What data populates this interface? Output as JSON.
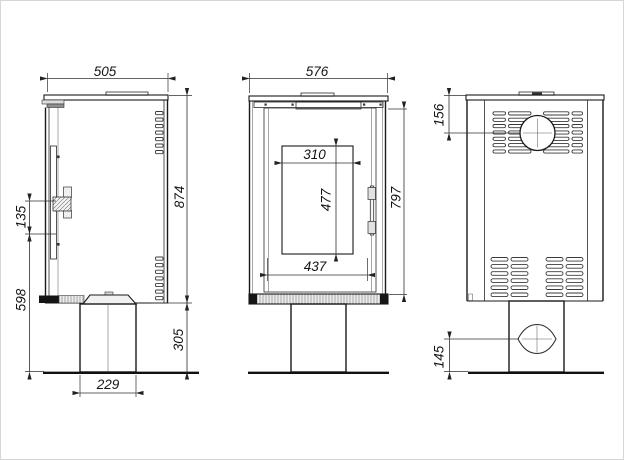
{
  "drawing": {
    "type": "technical-dimension-drawing",
    "subject": "freestanding stove on pedestal: side, front and back elevations",
    "views": {
      "side": {
        "dims": {
          "depth": "505",
          "body_height": "874",
          "handle_length": "135",
          "handle_height_from_floor": "598",
          "pedestal_height": "305",
          "pedestal_depth": "229"
        }
      },
      "front": {
        "dims": {
          "width": "576",
          "glass_width": "310",
          "glass_height": "477",
          "door_width": "437",
          "body_height": "797"
        }
      },
      "back": {
        "dims": {
          "flue_centre_from_top": "156",
          "air_inlet_centre_from_floor": "145"
        }
      }
    },
    "colors": {
      "outline": "#1a1a1a",
      "dimension_lines": "#2f2f2f",
      "hatch_fill": "#ececec",
      "background": "#ffffff"
    }
  }
}
